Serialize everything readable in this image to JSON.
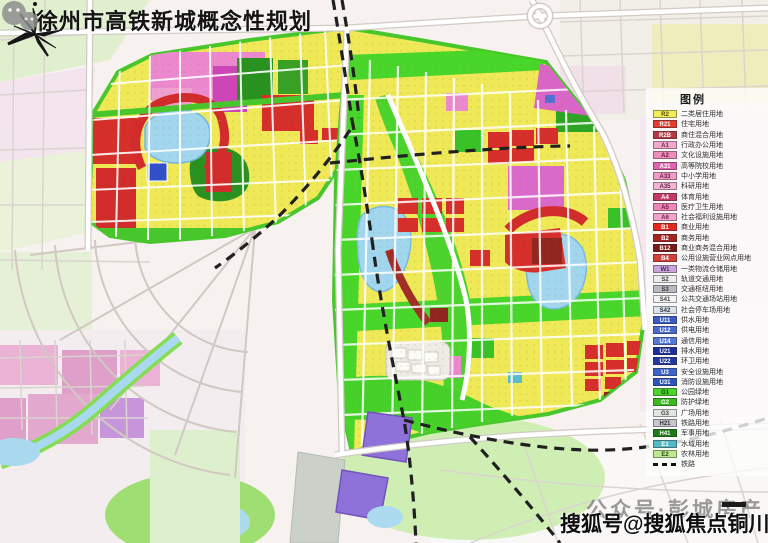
{
  "title": "徐州市高铁新城概念性规划",
  "legend": {
    "header": "图例",
    "items": [
      {
        "code": "R2",
        "label": "二类居住用地",
        "chip": "#f2ec5c",
        "text_color": "#5a4a00"
      },
      {
        "code": "R21",
        "label": "住宅用地",
        "chip": "#e23c30",
        "text_color": "#ffffff"
      },
      {
        "code": "R2B",
        "label": "商住混合用地",
        "chip": "#b23a44",
        "text_color": "#ffffff"
      },
      {
        "code": "A1",
        "label": "行政办公用地",
        "chip": "#f2a8cc",
        "text_color": "#6a2a4a"
      },
      {
        "code": "A2",
        "label": "文化设施用地",
        "chip": "#ee8cba",
        "text_color": "#6a1a40"
      },
      {
        "code": "A31",
        "label": "高等院校用地",
        "chip": "#e262ae",
        "text_color": "#ffffff"
      },
      {
        "code": "A33",
        "label": "中小学用地",
        "chip": "#f09cc6",
        "text_color": "#6a1a40"
      },
      {
        "code": "A35",
        "label": "科研用地",
        "chip": "#f2b4d4",
        "text_color": "#6a2a4a"
      },
      {
        "code": "A4",
        "label": "体育用地",
        "chip": "#c23a66",
        "text_color": "#ffffff"
      },
      {
        "code": "A5",
        "label": "医疗卫生用地",
        "chip": "#ee86b8",
        "text_color": "#6a1a40"
      },
      {
        "code": "A6",
        "label": "社会福利设施用地",
        "chip": "#f0a2ca",
        "text_color": "#6a2a4a"
      },
      {
        "code": "B1",
        "label": "商业用地",
        "chip": "#e02a20",
        "text_color": "#ffffff"
      },
      {
        "code": "B2",
        "label": "商务用地",
        "chip": "#a62420",
        "text_color": "#ffffff"
      },
      {
        "code": "B12",
        "label": "商业商务混合用地",
        "chip": "#7c1a16",
        "text_color": "#ffffff"
      },
      {
        "code": "B4",
        "label": "公用设施营业网点用地",
        "chip": "#d2423a",
        "text_color": "#ffffff"
      },
      {
        "code": "W1",
        "label": "一类物流仓储用地",
        "chip": "#caa4da",
        "text_color": "#3a2a50"
      },
      {
        "code": "S2",
        "label": "轨道交通用地",
        "chip": "#ececec",
        "text_color": "#444444"
      },
      {
        "code": "S3",
        "label": "交通枢纽用地",
        "chip": "#babac2",
        "text_color": "#333333"
      },
      {
        "code": "S41",
        "label": "公共交通场站用地",
        "chip": "#f4f4f4",
        "text_color": "#444444"
      },
      {
        "code": "S42",
        "label": "社会停车场用地",
        "chip": "#d8e4ea",
        "text_color": "#333344"
      },
      {
        "code": "U11",
        "label": "供水用地",
        "chip": "#3a5ac8",
        "text_color": "#ffffff"
      },
      {
        "code": "U12",
        "label": "供电用地",
        "chip": "#4a6ad0",
        "text_color": "#ffffff"
      },
      {
        "code": "U14",
        "label": "通信用地",
        "chip": "#5278d8",
        "text_color": "#ffffff"
      },
      {
        "code": "U21",
        "label": "排水用地",
        "chip": "#1c2e9c",
        "text_color": "#ffffff"
      },
      {
        "code": "U22",
        "label": "环卫用地",
        "chip": "#2438a2",
        "text_color": "#ffffff"
      },
      {
        "code": "U3",
        "label": "安全设施用地",
        "chip": "#3c64ca",
        "text_color": "#ffffff"
      },
      {
        "code": "U31",
        "label": "消防设施用地",
        "chip": "#2c54ba",
        "text_color": "#ffffff"
      },
      {
        "code": "G1",
        "label": "公园绿地",
        "chip": "#4ad62a",
        "text_color": "#14400a"
      },
      {
        "code": "G2",
        "label": "防护绿地",
        "chip": "#3aba20",
        "text_color": "#ffffff"
      },
      {
        "code": "G3",
        "label": "广场用地",
        "chip": "#e2e6e2",
        "text_color": "#444444"
      },
      {
        "code": "H21",
        "label": "铁路用地",
        "chip": "#c6c6cc",
        "text_color": "#333333"
      },
      {
        "code": "H41",
        "label": "军事用地",
        "chip": "#1c7c16",
        "text_color": "#ffffff"
      },
      {
        "code": "E1",
        "label": "水域用地",
        "chip": "#54b8c6",
        "text_color": "#ffffff"
      },
      {
        "code": "E2",
        "label": "农林用地",
        "chip": "#bce892",
        "text_color": "#2a4a10"
      },
      {
        "code": "",
        "label": "铁路",
        "symbol": "dashed-line"
      }
    ]
  },
  "watermarks": {
    "wechat_line": "公众号·彭城房产",
    "sohu_line": "搜狐号@搜狐焦点铜川站"
  },
  "icons": {
    "wechat": "wechat-icon",
    "compass": "north-star-icon"
  },
  "map_palette": {
    "residential_yellow": "#efe74e",
    "commercial_red": "#d42420",
    "business_dark_red": "#8c1a14",
    "admin_pink": "#ea82cc",
    "education_magenta": "#d862c8",
    "park_green": "#3ed41e",
    "forest_dark_green": "#1f8c16",
    "water_blue": "#9cd4ee",
    "utility_violet": "#8a6ad8",
    "railway_dash": "#151515"
  }
}
